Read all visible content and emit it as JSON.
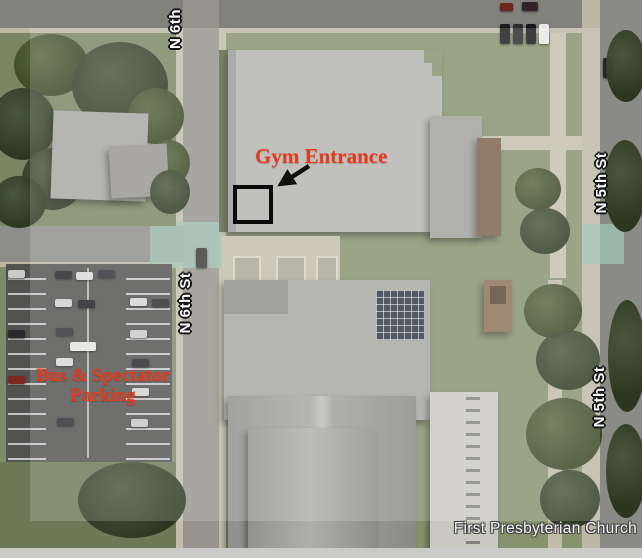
{
  "map": {
    "watermark": "First Presbyterian Church",
    "street_labels": [
      {
        "id": "top",
        "text": "N 6th"
      },
      {
        "id": "left",
        "text": "N 6th St"
      },
      {
        "id": "right_upper",
        "text": "N 5th St"
      },
      {
        "id": "right_lower",
        "text": "N 5th St"
      }
    ],
    "annotations": {
      "gym_label": "Gym Entrance",
      "parking_line1": "Bus & Spectator",
      "parking_line2": "Parking"
    },
    "colors": {
      "annotation_red": "#e8391c",
      "marker_black": "#0b0b0b",
      "street_label_fill": "#ffffff",
      "street_label_outline": "#151515",
      "watermark_fill": "#f5f5f5",
      "crosswalk_teal": "#9cc0ae",
      "highlight_overlay": "rgba(255,255,255,0.17)"
    }
  }
}
